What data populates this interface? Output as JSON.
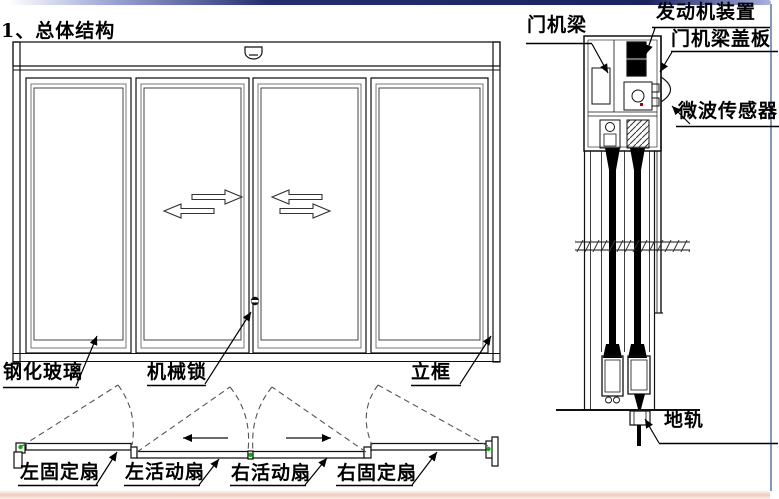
{
  "slide": {
    "title": "1、总体结构",
    "colors": {
      "line": "#000000",
      "pivot_green": "#00b400",
      "top_bar_navy": "#1a2360",
      "right_border_blue": "#8398bf",
      "bottom_tint_pink": "#efc9bc"
    }
  },
  "front_elevation": {
    "labels": {
      "glass": "钢化玻璃",
      "lock": "机械锁",
      "frame": "立框"
    }
  },
  "plan_view": {
    "labels": {
      "left_fixed": "左固定扇",
      "left_active": "左活动扇",
      "right_active": "右活动扇",
      "right_fixed": "右固定扇"
    }
  },
  "side_section": {
    "labels": {
      "door_machine_beam": "门机梁",
      "engine_unit": "发动机装置",
      "beam_cover": "门机梁盖板",
      "microwave_sensor": "微波传感器",
      "floor_track": "地轨"
    }
  }
}
